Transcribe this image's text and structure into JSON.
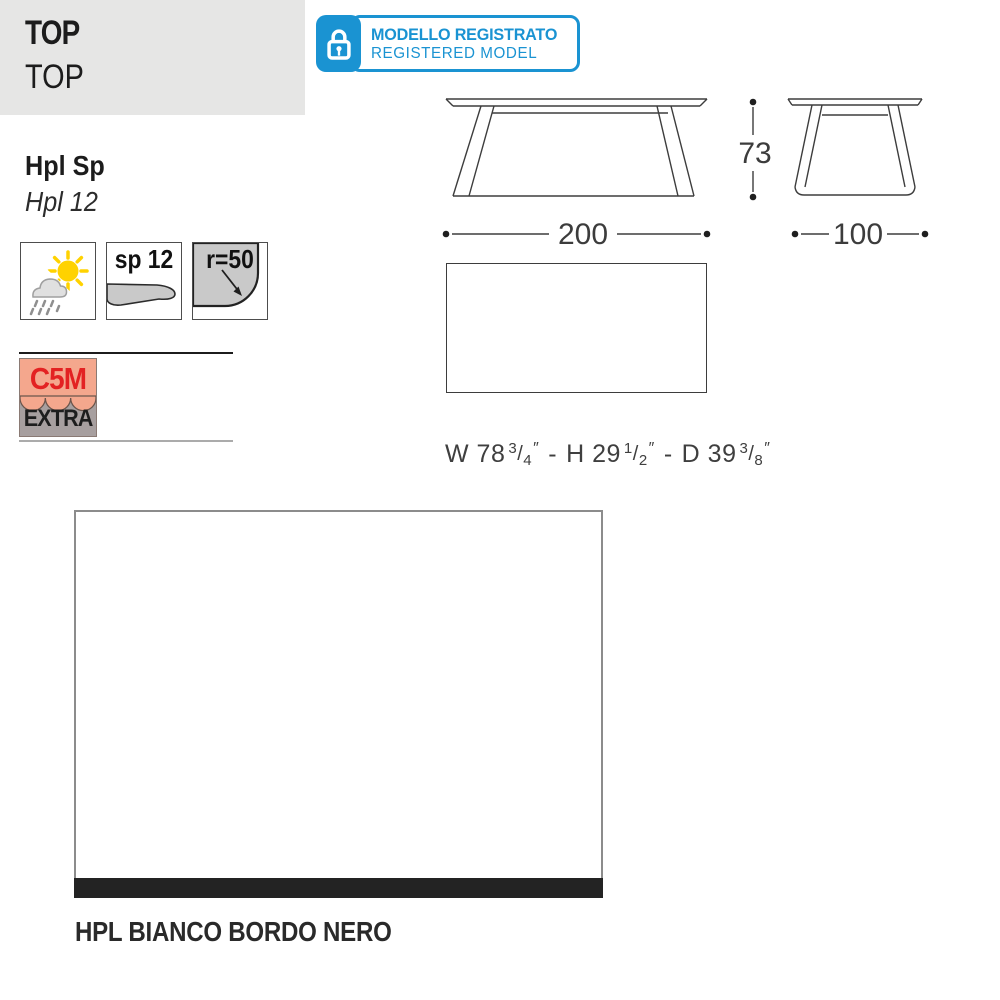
{
  "header": {
    "title": "TOP",
    "subtitle": "TOP"
  },
  "registered_badge": {
    "line1": "MODELLO REGISTRATO",
    "line2": "REGISTERED MODEL",
    "accent_color": "#1a93d2"
  },
  "material": {
    "bold_label": "Hpl Sp",
    "italic_label": "Hpl 12"
  },
  "feature_icons": {
    "weather_icon_meaning": "indoor-outdoor-weather",
    "thickness_label": "sp 12",
    "radius_label": "r=50"
  },
  "certification_badge": {
    "line1": "C5M",
    "line2": "EXTRA",
    "line1_color": "#e32222",
    "top_bg": "#f4a78d",
    "bottom_bg": "#a79f9f"
  },
  "drawings": {
    "front_width": "200",
    "front_height": "73",
    "side_depth": "100"
  },
  "imperial_dimensions": {
    "w_label": "W 78",
    "w_frac_num": "3",
    "w_frac_den": "4",
    "h_label": "H 29",
    "h_frac_num": "1",
    "h_frac_den": "2",
    "d_label": "D 39",
    "d_frac_num": "3",
    "d_frac_den": "8",
    "inch_mark": "″",
    "dash": "-"
  },
  "finish": {
    "name": "HPL BIANCO BORDO NERO",
    "top_color": "#ffffff",
    "edge_color": "#232323"
  }
}
